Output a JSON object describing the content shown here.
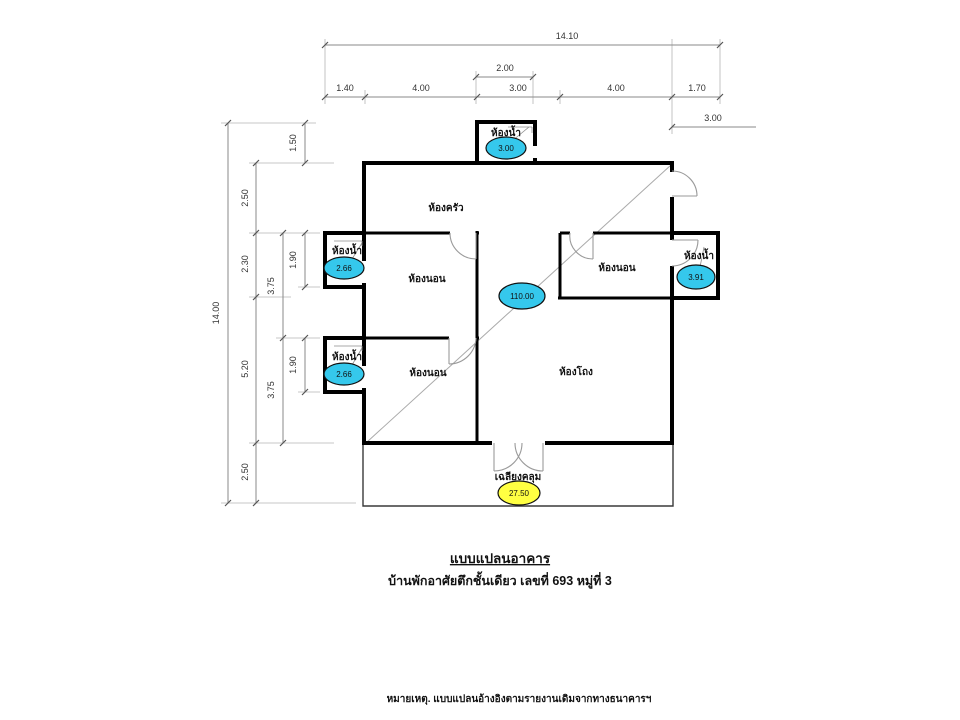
{
  "titles": {
    "heading": "แบบแปลนอาคาร",
    "subheading": "บ้านพักอาศัยตึกชั้นเดียว เลขที่ 693  หมู่ที่ 3",
    "note": "หมายเหตุ. แบบแปลนอ้างอิงตามรายงานเดิมจากทางธนาคารฯ"
  },
  "plan": {
    "total_area": "110.00",
    "rooms": [
      {
        "id": "kitchen",
        "label": "ห้องครัว"
      },
      {
        "id": "hall",
        "label": "ห้องโถง"
      },
      {
        "id": "bedroom-top-left",
        "label": "ห้องนอน"
      },
      {
        "id": "bedroom-bottom-left",
        "label": "ห้องนอน"
      },
      {
        "id": "bedroom-right",
        "label": "ห้องนอน"
      },
      {
        "id": "bathroom-top",
        "label": "ห้องน้ำ",
        "area": "3.00"
      },
      {
        "id": "bathroom-left-upper",
        "label": "ห้องน้ำ",
        "area": "2.66"
      },
      {
        "id": "bathroom-left-lower",
        "label": "ห้องน้ำ",
        "area": "2.66"
      },
      {
        "id": "bathroom-right",
        "label": "ห้องน้ำ",
        "area": "3.91"
      },
      {
        "id": "porch",
        "label": "เฉลียงคลุม",
        "area": "27.50"
      }
    ]
  },
  "dims": {
    "top_total": "14.10",
    "top_small": "2.00",
    "top_segments": [
      "1.40",
      "4.00",
      "3.00",
      "4.00",
      "1.70"
    ],
    "top_right": "3.00",
    "left_total": "14.00",
    "left_col2": [
      "2.50",
      "2.30",
      "5.20",
      "2.50"
    ],
    "left_col3": [
      "3.75",
      "3.75"
    ],
    "left_col4": [
      "1.50",
      "1.90",
      "1.90"
    ]
  },
  "colors": {
    "area_badge": "#35c8ec",
    "porch_badge": "#ffff42",
    "wall": "#000000",
    "dimension_line": "#8a8a8a"
  }
}
